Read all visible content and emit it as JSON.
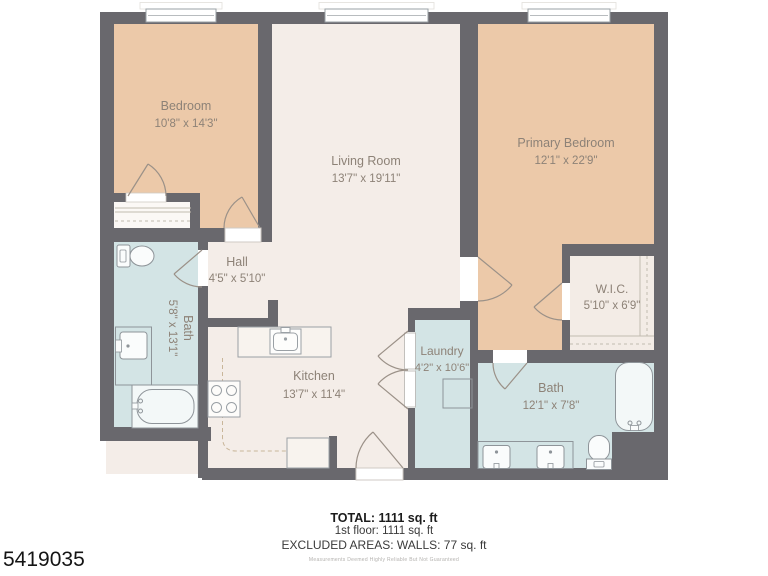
{
  "floor_plan": {
    "rooms": [
      {
        "name": "Bedroom",
        "dims": "10'8\" x 14'3\""
      },
      {
        "name": "Living Room",
        "dims": "13'7\" x 19'11\""
      },
      {
        "name": "Primary Bedroom",
        "dims": "12'1\" x 22'9\""
      },
      {
        "name": "Hall",
        "dims": "4'5\" x 5'10\""
      },
      {
        "name": "Bath",
        "dims": "5'8\" x 13'1\""
      },
      {
        "name": "W.I.C.",
        "dims": "5'10\" x 6'9\""
      },
      {
        "name": "Kitchen",
        "dims": "13'7\" x 11'4\""
      },
      {
        "name": "Laundry",
        "dims": "4'2\" x 10'6\""
      },
      {
        "name": "Bath",
        "dims": "12'1\" x 7'8\""
      }
    ],
    "summary": {
      "total": "TOTAL: 1111 sq. ft",
      "floor": "1st floor: 1111 sq. ft",
      "excluded": "EXCLUDED AREAS: WALLS: 77 sq. ft",
      "disclaimer": "Measurements Deemed Highly Reliable But Not Guaranteed"
    },
    "listing_id": "5419035",
    "colors": {
      "wall": "#69686d",
      "bedroom_fill": "#ecc9a9",
      "living_fill": "#f4ede8",
      "wet_room_fill": "#d3e4e5",
      "label_text": "#8d8277"
    }
  }
}
